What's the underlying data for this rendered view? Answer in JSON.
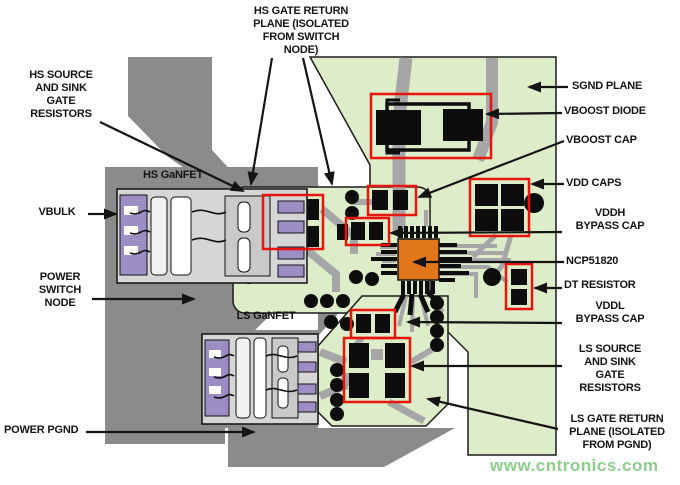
{
  "diagram": {
    "type": "annotated-pcb-layout",
    "chip_part": "NCP51820",
    "watermark": "www.cntronics.com",
    "colors": {
      "plane_green": "#DDEDC9",
      "copper_gray": "#8B8B8B",
      "trace_gray": "#A6A6A6",
      "pad_purple": "#9C8EC4",
      "chip_orange": "#E2761B",
      "annotation_red": "#E8150D",
      "watermark_green": "#8CCE8C"
    },
    "labels": {
      "hs_gate_return": "HS GATE RETURN\nPLANE (ISOLATED\nFROM SWITCH\nNODE)",
      "hs_source_sink": "HS SOURCE\nAND SINK\nGATE\nRESISTORS",
      "hs_ganfet": "HS GaNFET",
      "vbulk": "VBULK",
      "power_switch_node": "POWER\nSWITCH\nNODE",
      "ls_ganfet": "LS GaNFET",
      "power_pgnd": "POWER PGND",
      "sgnd_plane": "SGND PLANE",
      "vboost_diode": "VBOOST DIODE",
      "vboost_cap": "VBOOST CAP",
      "vdd_caps": "VDD CAPS",
      "vddh_bypass": "VDDH\nBYPASS CAP",
      "ncp51820": "NCP51820",
      "dt_resistor": "DT RESISTOR",
      "vddl_bypass": "VDDL\nBYPASS CAP",
      "ls_source_sink": "LS SOURCE\nAND SINK\nGATE\nRESISTORS",
      "ls_gate_return": "LS GATE RETURN\nPLANE (ISOLATED\nFROM PGND)"
    }
  }
}
